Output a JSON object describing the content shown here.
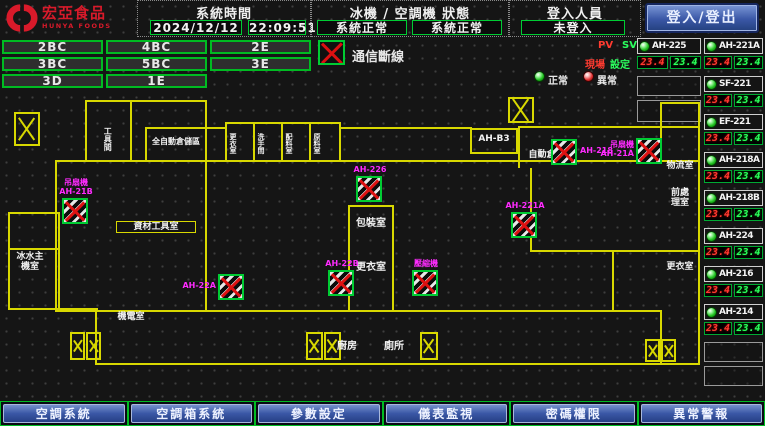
{
  "header": {
    "logo": {
      "title": "宏亞食品",
      "subtitle": "HUNYA FOODS"
    },
    "system_time": {
      "label": "系統時間",
      "date": "2024/12/12",
      "time": "22:09:51"
    },
    "machine_status": {
      "label": "冰機 / 空調機 狀態",
      "chiller": "系統正常",
      "ahu": "系統正常"
    },
    "login": {
      "label": "登入人員",
      "value": "未登入",
      "button": "登入/登出"
    }
  },
  "floor_buttons": [
    "2BC",
    "4BC",
    "2E",
    "3BC",
    "5BC",
    "3E",
    "3D",
    "1E"
  ],
  "legend": {
    "comm_error": "通信斷線",
    "normal": "正常",
    "abnormal": "異常",
    "pv": "PV",
    "sv": "SV",
    "pv_label": "現場",
    "sv_label": "設定"
  },
  "sidebar": {
    "col_a": {
      "name": "AH-225",
      "pv": "23.4",
      "sv": "23.4"
    },
    "col_b_units": [
      {
        "name": "AH-221A",
        "pv": "23.4",
        "sv": "23.4"
      },
      {
        "name": "SF-221",
        "pv": "23.4",
        "sv": "23.4"
      },
      {
        "name": "EF-221",
        "pv": "23.4",
        "sv": "23.4"
      },
      {
        "name": "AH-218A",
        "pv": "23.4",
        "sv": "23.4"
      },
      {
        "name": "AH-218B",
        "pv": "23.4",
        "sv": "23.4"
      },
      {
        "name": "AH-224",
        "pv": "23.4",
        "sv": "23.4"
      },
      {
        "name": "AH-216",
        "pv": "23.4",
        "sv": "23.4"
      },
      {
        "name": "AH-214",
        "pv": "23.4",
        "sv": "23.4"
      }
    ]
  },
  "map": {
    "rooms": [
      {
        "t": "工具間",
        "x": 103,
        "y": 120,
        "h": 38,
        "fs": 8,
        "vert": true
      },
      {
        "t": "全自動倉儲區",
        "x": 147,
        "y": 137,
        "w": 58,
        "fs": 8
      },
      {
        "t": "更衣室",
        "x": 229,
        "y": 125,
        "h": 36,
        "fs": 7,
        "vert": true
      },
      {
        "t": "洗手間",
        "x": 257,
        "y": 125,
        "h": 36,
        "fs": 7,
        "vert": true
      },
      {
        "t": "配料室",
        "x": 285,
        "y": 125,
        "h": 36,
        "fs": 7,
        "vert": true
      },
      {
        "t": "原料室",
        "x": 313,
        "y": 125,
        "h": 36,
        "fs": 7,
        "vert": true
      },
      {
        "t": "AH-B3",
        "x": 473,
        "y": 134,
        "w": 42,
        "fs": 9
      },
      {
        "t": "自動倉儲室",
        "x": 520,
        "y": 150,
        "w": 62,
        "fs": 9
      },
      {
        "t": "資材工具室",
        "x": 116,
        "y": 221,
        "w": 76,
        "fs": 9,
        "border": true
      },
      {
        "t": "包裝室",
        "x": 352,
        "y": 218,
        "w": 38,
        "fs": 10
      },
      {
        "t": "更衣室",
        "x": 352,
        "y": 262,
        "w": 38,
        "fs": 10
      },
      {
        "t": "冰水主機室",
        "x": 16,
        "y": 252,
        "w": 28,
        "fs": 9
      },
      {
        "t": "機電室",
        "x": 110,
        "y": 312,
        "w": 42,
        "fs": 9
      },
      {
        "t": "物流室",
        "x": 663,
        "y": 161,
        "w": 34,
        "fs": 9
      },
      {
        "t": "前處理室",
        "x": 669,
        "y": 188,
        "w": 22,
        "fs": 9
      },
      {
        "t": "更衣室",
        "x": 663,
        "y": 262,
        "w": 34,
        "fs": 9
      },
      {
        "t": "廚房",
        "x": 334,
        "y": 341,
        "w": 26,
        "fs": 10
      },
      {
        "t": "廁所",
        "x": 381,
        "y": 341,
        "w": 26,
        "fs": 10
      }
    ],
    "devices": [
      {
        "label": "吊扇機\nAH-21B",
        "x": 62,
        "y": 198,
        "pos": "above"
      },
      {
        "label": "AH-22A",
        "x": 218,
        "y": 274,
        "pos": "left"
      },
      {
        "label": "AH-22B",
        "x": 328,
        "y": 270,
        "pos": "above"
      },
      {
        "label": "壓縮機",
        "x": 412,
        "y": 270,
        "pos": "above"
      },
      {
        "label": "AH-226",
        "x": 356,
        "y": 176,
        "pos": "above"
      },
      {
        "label": "AH-221A",
        "x": 511,
        "y": 212,
        "pos": "above"
      },
      {
        "label": "AH-218",
        "x": 551,
        "y": 139,
        "pos": "right"
      },
      {
        "label": "吊扇機\nAH-21A",
        "x": 636,
        "y": 138,
        "pos": "left"
      }
    ],
    "walls": [
      [
        85,
        100,
        122,
        2
      ],
      [
        85,
        100,
        2,
        62
      ],
      [
        130,
        102,
        2,
        60
      ],
      [
        205,
        100,
        2,
        62
      ],
      [
        145,
        127,
        82,
        2
      ],
      [
        145,
        127,
        2,
        33
      ],
      [
        225,
        122,
        116,
        2
      ],
      [
        225,
        122,
        2,
        40
      ],
      [
        253,
        122,
        2,
        40
      ],
      [
        281,
        122,
        2,
        40
      ],
      [
        309,
        122,
        2,
        40
      ],
      [
        339,
        122,
        2,
        40
      ],
      [
        341,
        127,
        131,
        2
      ],
      [
        470,
        128,
        48,
        2
      ],
      [
        470,
        128,
        2,
        26
      ],
      [
        516,
        128,
        2,
        26
      ],
      [
        470,
        152,
        48,
        2
      ],
      [
        518,
        126,
        182,
        2
      ],
      [
        518,
        126,
        2,
        42
      ],
      [
        660,
        102,
        40,
        2
      ],
      [
        660,
        102,
        2,
        60
      ],
      [
        55,
        160,
        645,
        2
      ],
      [
        55,
        160,
        2,
        152
      ],
      [
        698,
        102,
        2,
        263
      ],
      [
        8,
        212,
        52,
        2
      ],
      [
        8,
        212,
        2,
        98
      ],
      [
        58,
        212,
        2,
        98
      ],
      [
        8,
        248,
        52,
        2
      ],
      [
        8,
        308,
        90,
        2
      ],
      [
        95,
        310,
        2,
        55
      ],
      [
        95,
        363,
        605,
        2
      ],
      [
        205,
        162,
        2,
        148
      ],
      [
        348,
        205,
        46,
        2
      ],
      [
        348,
        205,
        2,
        107
      ],
      [
        392,
        205,
        2,
        107
      ],
      [
        530,
        168,
        2,
        84
      ],
      [
        530,
        250,
        170,
        2
      ],
      [
        612,
        250,
        2,
        62
      ],
      [
        55,
        310,
        607,
        2
      ],
      [
        660,
        310,
        2,
        55
      ]
    ],
    "stairs": [
      [
        14,
        112,
        26,
        34
      ],
      [
        508,
        97,
        26,
        26
      ],
      [
        70,
        332,
        15,
        28
      ],
      [
        86,
        332,
        15,
        28
      ],
      [
        306,
        332,
        17,
        28
      ],
      [
        324,
        332,
        17,
        28
      ],
      [
        420,
        332,
        18,
        28
      ],
      [
        645,
        339,
        15,
        23
      ],
      [
        661,
        339,
        15,
        23
      ]
    ]
  },
  "nav_buttons": [
    "空調系統",
    "空調箱系統",
    "參數設定",
    "儀表監視",
    "密碼權限",
    "異常警報"
  ],
  "colors": {
    "accent_green": "#00cc33",
    "alarm_red": "#dd1111",
    "magenta": "#ff2bff",
    "wall_yellow": "#d8d800",
    "nav_blue": "#3a57a6",
    "logo_red": "#d81a2a"
  }
}
